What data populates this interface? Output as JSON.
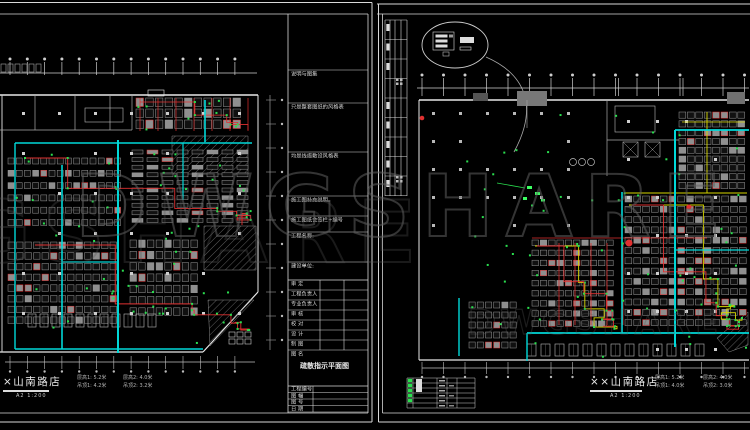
{
  "watermark": {
    "text": "DWGSHARE"
  },
  "colors": {
    "background": "#000000",
    "line": "#d9d9d9",
    "dim": "#9a9a9a",
    "cyan": "#00d8d8",
    "red": "#e03030",
    "yellow": "#d9d900",
    "green": "#2adf4f",
    "watermark": "#606060"
  },
  "left_sheet": {
    "title": "×山南路店",
    "scale": "A2  1:200",
    "annotations": {
      "c1r1": "层高1: 5.2米",
      "c1r2": "吊顶1: 4.2米",
      "c2r1": "层高2: 4.0米",
      "c2r2": "吊顶2: 3.2米"
    },
    "titleblock": {
      "notes": [
        "说明与图集",
        "只是整套图纸的风格表",
        "均是线缆敷设风格表",
        "施工图补充说明。",
        "施工图纸会签栏+编号"
      ],
      "project_label": "工程名称:",
      "owner_label": "建设单位:",
      "sign_rows": [
        "审  定",
        "工程负责人",
        "专业负责人",
        "审  核",
        "校  对",
        "设  计",
        "制  图"
      ],
      "name_label": "图 名",
      "drawing_name": "疏散指示平面图",
      "footer_rows": [
        "工程编号",
        "图  幅",
        "图  号",
        "日  期"
      ]
    }
  },
  "right_sheet": {
    "title": "××山南路店",
    "scale": "A2  1:200",
    "annotations": {
      "c1r1": "层高1: 5.2米",
      "c1r2": "吊顶1: 4.0米",
      "c2r1": "层高2: 4.0米",
      "c2r2": "吊顶2: 3.0米"
    }
  }
}
